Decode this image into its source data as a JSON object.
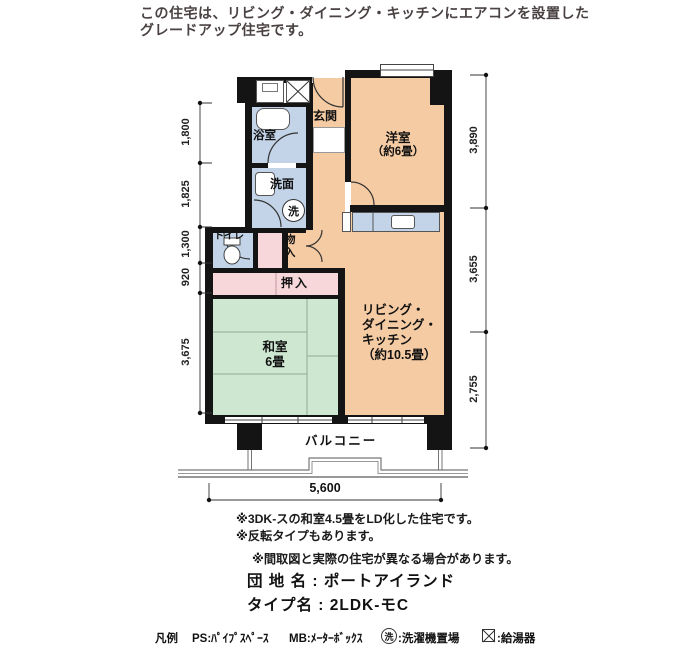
{
  "header": {
    "line1": "この住宅は、リビング・ダイニング・キッチンにエアコンを設置した",
    "line2": "グレードアップ住宅です。"
  },
  "plan": {
    "labels": {
      "genkan": "玄関",
      "yoshitsu_line1": "洋室",
      "yoshitsu_line2": "（約6畳）",
      "yokushitsu": "浴室",
      "senmen": "洗面",
      "sen": "洗",
      "toire": "トイレ",
      "mono_line1": "物",
      "mono_line2": "入",
      "oshiire": "押入",
      "washitsu_line1": "和室",
      "washitsu_line2": "6畳",
      "ldk_line1": "リビング・",
      "ldk_line2": "ダイニング・",
      "ldk_line3": "キッチン",
      "ldk_line4": "（約10.5畳）",
      "balcony": "バルコニー"
    },
    "dimensions": {
      "left": [
        "1,800",
        "1,825",
        "1,300",
        "920",
        "3,675"
      ],
      "right": [
        "3,890",
        "3,655",
        "2,755"
      ],
      "bottom": "5,600"
    }
  },
  "notes": [
    "※3DK-スの和室4.5畳をLD化した住宅です。",
    "※反転タイプもあります。",
    "※間取図と実際の住宅が異なる場合があります。"
  ],
  "estate": {
    "danchi": "団 地 名 : ポートアイランド",
    "type": "タイプ名 : 2LDK-モC"
  },
  "legend": {
    "title": "凡例",
    "ps": "PS:ﾊﾟｲﾌﾟｽﾍﾟｰｽ",
    "mb": "MB:ﾒｰﾀｰﾎﾞｯｸｽ",
    "sen_symbol": "洗",
    "sen_label": ":洗濯機置場",
    "boiler_label": ":給湯器"
  },
  "colors": {
    "room_warm": "#F5CBA4",
    "room_wet": "#C3D4E8",
    "room_closet": "#F8D7DB",
    "room_tatami": "#CDE7D0",
    "wall": "#141414"
  }
}
